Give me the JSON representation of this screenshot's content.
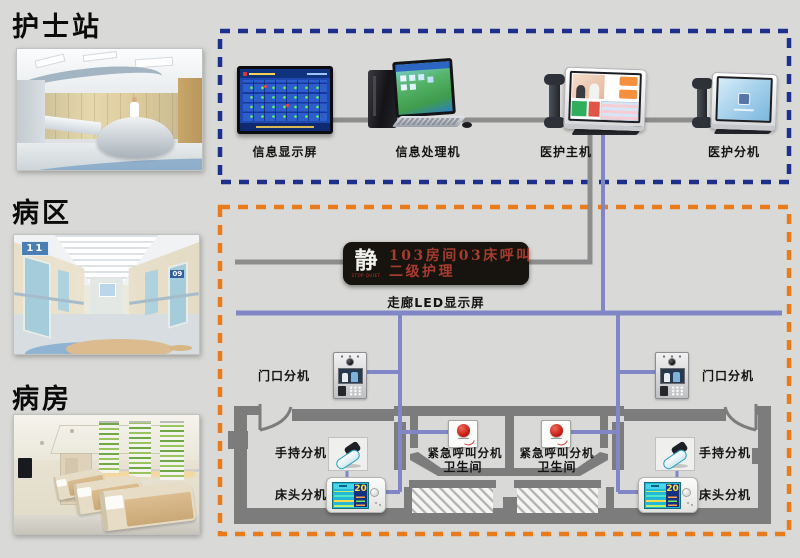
{
  "sections": {
    "nurse_station": "护士站",
    "ward_area": "病区",
    "ward_room": "病房"
  },
  "ward_signs": {
    "left": "11",
    "right": "09"
  },
  "top_devices": {
    "display": "信息显示屏",
    "computer": "信息处理机",
    "host": "医护主机",
    "extension": "医护分机"
  },
  "led": {
    "quiet_char": "静",
    "quiet_caption": "STOP QUIET",
    "line1": "103房间03床呼叫",
    "line2": "二级护理",
    "caption": "走廊LED显示屏"
  },
  "plan": {
    "left": {
      "door": "门口分机",
      "handheld": "手持分机",
      "bedside": "床头分机",
      "bedside_value": "20",
      "emergency": "紧急呼叫分机",
      "bathroom": "卫生间"
    },
    "right": {
      "door": "门口分机",
      "handheld": "手持分机",
      "bedside": "床头分机",
      "bedside_value": "20",
      "emergency": "紧急呼叫分机",
      "bathroom": "卫生间"
    }
  },
  "colors": {
    "background": "#d9d9d7",
    "dashed_blue": "#1f2f8e",
    "dashed_orange": "#ea7b1a",
    "line_violet": "#8186c6",
    "line_gray": "#8d8d8d",
    "wall_gray": "#7c7c7c",
    "led_red": "#a63c2e"
  }
}
